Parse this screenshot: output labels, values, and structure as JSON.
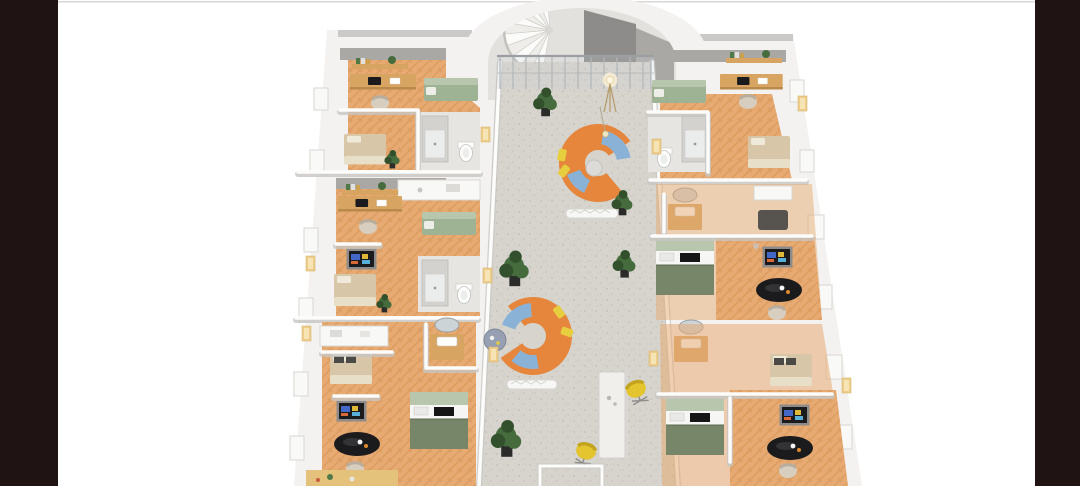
{
  "scene": {
    "kind": "isometric-3d-floor-plan-render",
    "areas": {
      "stair_lobby": [
        "arched-opening",
        "spiral-staircase",
        "glass-railing",
        "floor-lamp",
        "potted-plant"
      ],
      "lounge_corridor": [
        "curved-sofa-upper",
        "curved-sofa-lower",
        "hanging-lamp",
        "side-table",
        "sculpture-bench",
        "standing-table",
        "yellow-desk-chairs",
        "potted-plants",
        "entry-vestibule",
        "window-lights"
      ],
      "left_wing_units": [
        "wall-shelf",
        "work-desk",
        "office-chair",
        "green-sofa-bed",
        "single-bed",
        "shower",
        "toilet",
        "sink-vanity",
        "wall-tv",
        "dining-table",
        "kitchenette",
        "plants"
      ],
      "right_wing_units": [
        "wall-shelf",
        "work-desk",
        "office-chair",
        "green-sofa-bed",
        "single-bed",
        "shower",
        "toilet",
        "sink-vanity",
        "wall-tv",
        "dining-table",
        "kitchenette",
        "plants"
      ]
    },
    "unit_count_left": 3,
    "unit_count_right": 3
  },
  "colors": {
    "letterbox": "#1f1413",
    "background": "#ffffff",
    "hairline": "#d9d6d8",
    "wall_light": "#f3f2f0",
    "wall_white": "#fcfcfb",
    "wall_shadow": "#c7c6c3",
    "wall_gray": "#a9a8a5",
    "wall_gray_dark": "#8d8c8a",
    "floor_concrete": "#d6d4cd",
    "speckle": "#bfbdb5",
    "floor_wood": "#e6aa72",
    "wood_stripe": "#d3904f",
    "wood_furniture": "#d7a462",
    "cabinet_green": "#9eb394",
    "cabinet_green_light": "#b7c6ad",
    "cabinet_green_dark": "#778668",
    "bed_beige": "#d7c6a8",
    "pillow_dark": "#4b4a47",
    "sofa_orange": "#e5863c",
    "cushion_blue": "#8ab2d7",
    "pillow_yellow": "#e7ce3f",
    "chair_yellow": "#e4c530",
    "chair_beige": "#d8cec0",
    "plant_green": "#466c3e",
    "plant_green_dark": "#32502c",
    "pot_black": "#2b2b2a",
    "black_furniture": "#1b1b1d",
    "window_glow": "#eccd8c",
    "bathroom_floor": "#e6e5e2",
    "shower_gray": "#d3d2cf",
    "white_fixture": "#fdfdfc",
    "glass": "#b8bec2",
    "screen_blue": "#4468c8",
    "screen_yellow": "#e0b83a"
  }
}
